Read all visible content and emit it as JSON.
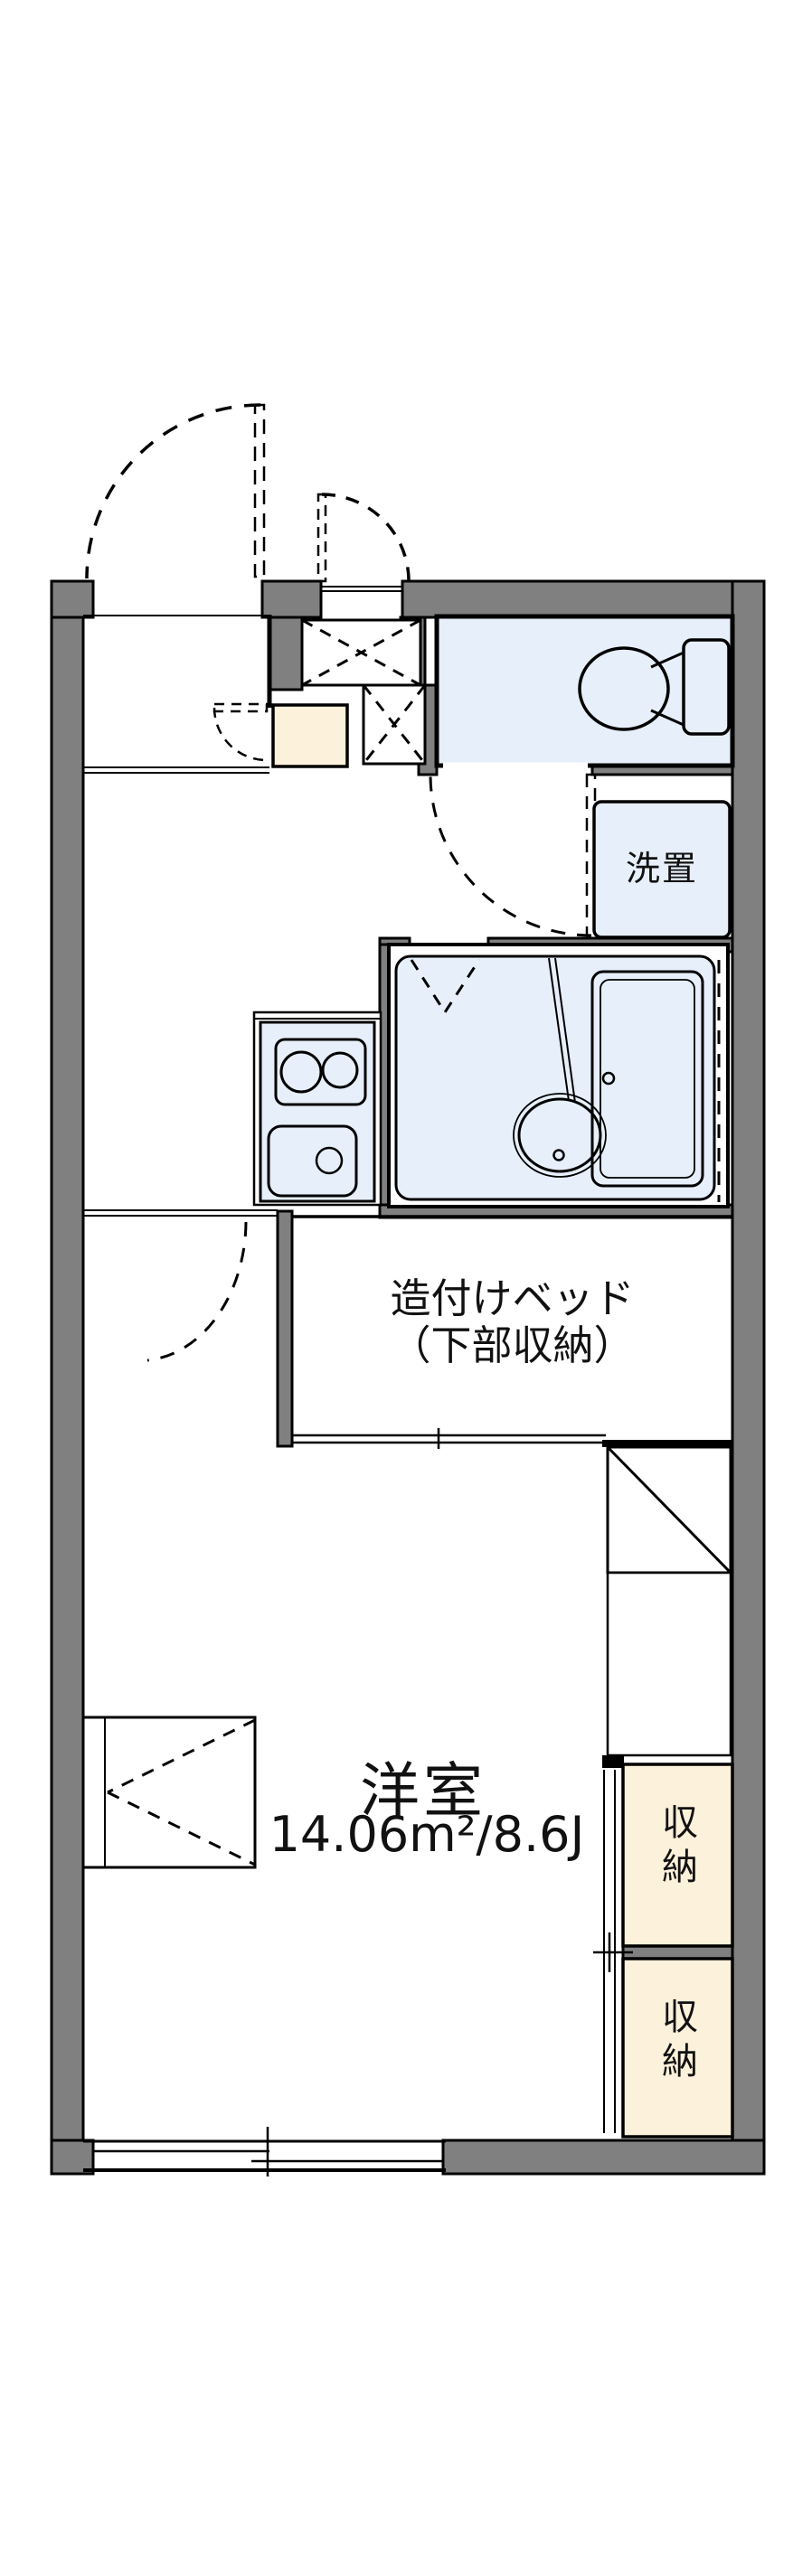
{
  "floorplan": {
    "type": "japanese-apartment-floor-plan",
    "labels": {
      "washer": "洗置",
      "bed_line1": "造付けベッド",
      "bed_line2": "（下部収納）",
      "room_name": "洋室",
      "room_size": "14.06m²/8.6J",
      "storage_upper": "収納",
      "storage_lower": "収納"
    },
    "colors": {
      "background": "#FFFFFF",
      "wall_fill": "#808080",
      "outline": "#000000",
      "wet_area_fill": "#E7EFFA",
      "storage_fill": "#FCF1DA",
      "text": "#111111"
    }
  }
}
